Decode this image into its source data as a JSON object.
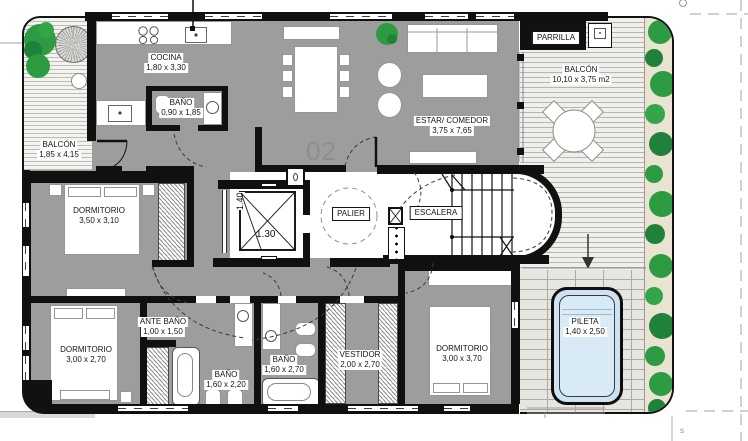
{
  "unit": {
    "number": "02"
  },
  "rooms": {
    "balcon_izq": {
      "name": "BALCÓN",
      "dims": "1,85 x 4,15"
    },
    "cocina": {
      "name": "COCINA",
      "dims": "1,80 x 3,30"
    },
    "bano_cocina": {
      "name": "BAÑO",
      "dims": "0,90 x 1,85"
    },
    "estar_comedor": {
      "name": "ESTAR/ COMEDOR",
      "dims": "3,75 x 7,65"
    },
    "parrilla": {
      "name": "PARRILLA"
    },
    "balcon_der": {
      "name": "BALCÓN",
      "dims": "10,10 x 3,75 m2"
    },
    "dormitorio_1": {
      "name": "DORMITORIO",
      "dims": "3,50 x 3,10"
    },
    "palier": {
      "name": "PALIER"
    },
    "escalera": {
      "name": "ESCALERA"
    },
    "dormitorio_2": {
      "name": "DORMITORIO",
      "dims": "3,00 x 2,70"
    },
    "ante_bano": {
      "name": "ANTE BAÑO",
      "dims": "1,00 x 1,50"
    },
    "bano_1": {
      "name": "BAÑO",
      "dims": "1,60 x 2,20"
    },
    "bano_2": {
      "name": "BAÑO",
      "dims": "1,60 x 2,70"
    },
    "vestidor": {
      "name": "VESTIDOR",
      "dims": "2,00 x 2,70"
    },
    "dormitorio_3": {
      "name": "DORMITORIO",
      "dims": "3,00 x 3,70"
    },
    "pileta": {
      "name": "PILETA",
      "dims": "1,40 x 2,50"
    }
  },
  "elevator": {
    "width": "1.40",
    "depth": "1.30"
  },
  "annotations": {
    "survey_mark": "s"
  },
  "colors": {
    "floor": "#9d9d9d",
    "wall": "#101010",
    "hedge_green": "#2d9b41",
    "pool_blue": "#cde2f3",
    "unit_text": "#8e8e8e"
  }
}
